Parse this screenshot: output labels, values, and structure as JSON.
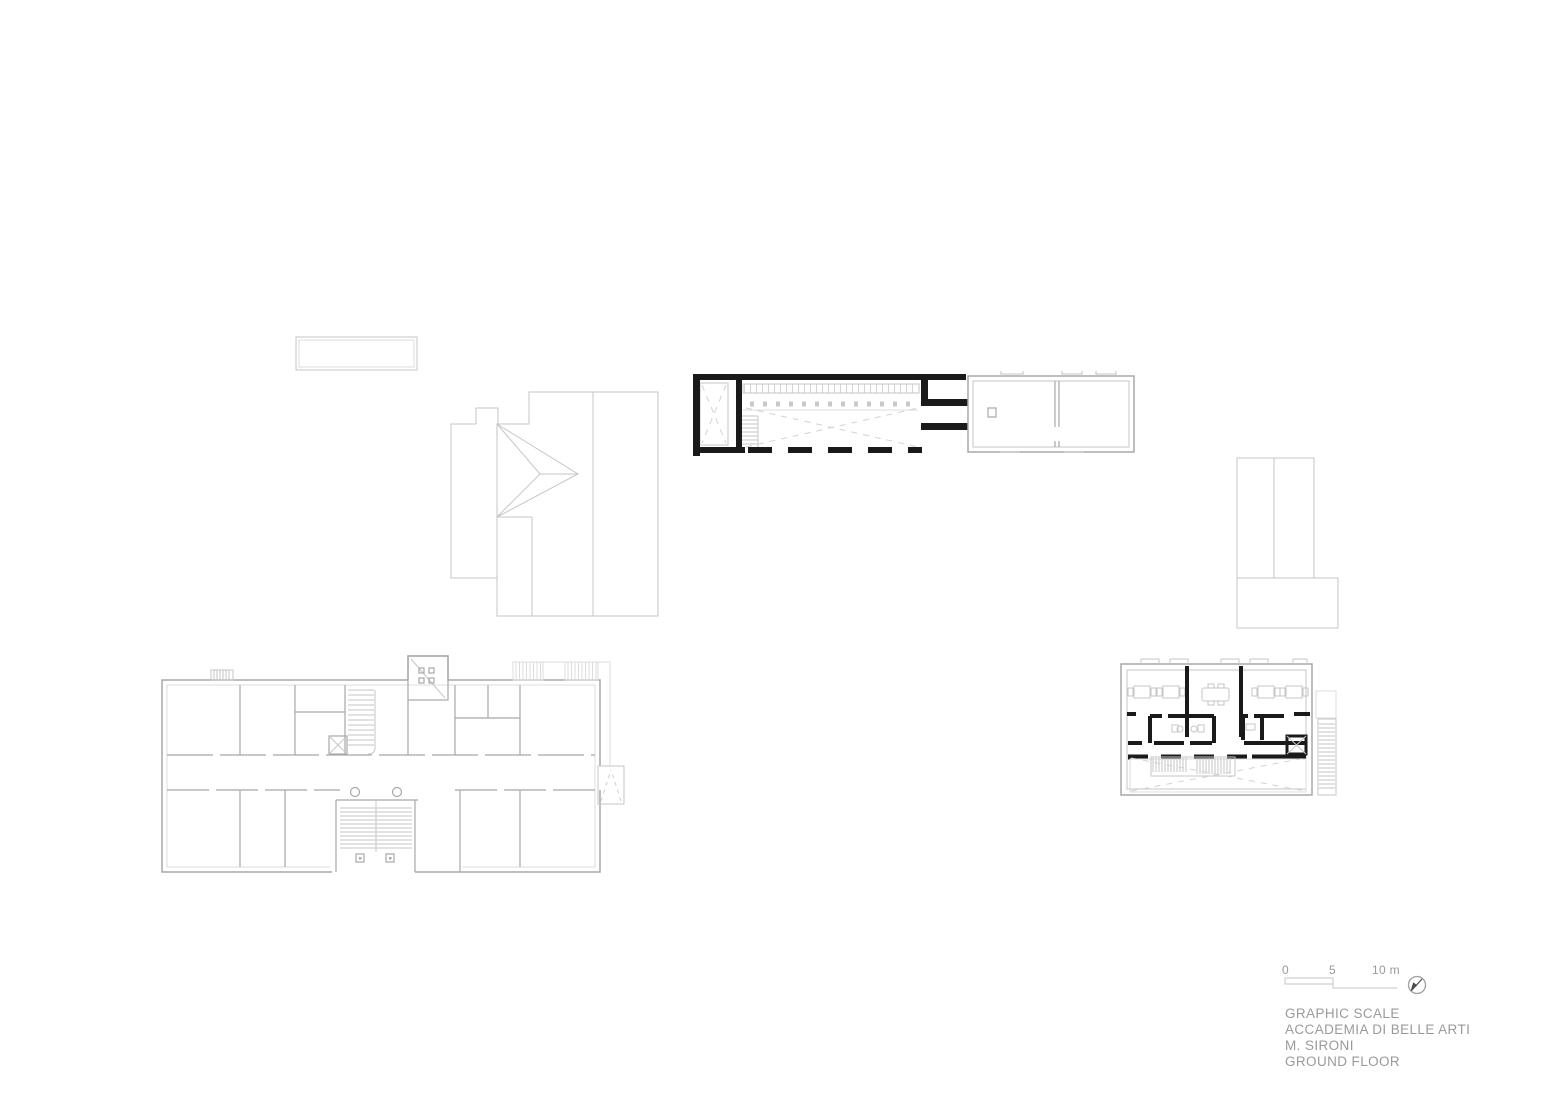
{
  "colors": {
    "background": "#ffffff",
    "line_light": "#c6c6c6",
    "line_mid": "#a8a8a8",
    "highlight_ink": "#1a1a1a",
    "dashed_guides": "#d2d2d2",
    "text_gray": "#9a9a9a"
  },
  "scale_bar": {
    "tick0": "0",
    "tick5": "5",
    "tick10": "10 m"
  },
  "title_block": {
    "lines": [
      "GRAPHIC SCALE",
      "ACCADEMIA DI BELLE ARTI",
      "M. SIRONI",
      "GROUND FLOOR"
    ]
  }
}
